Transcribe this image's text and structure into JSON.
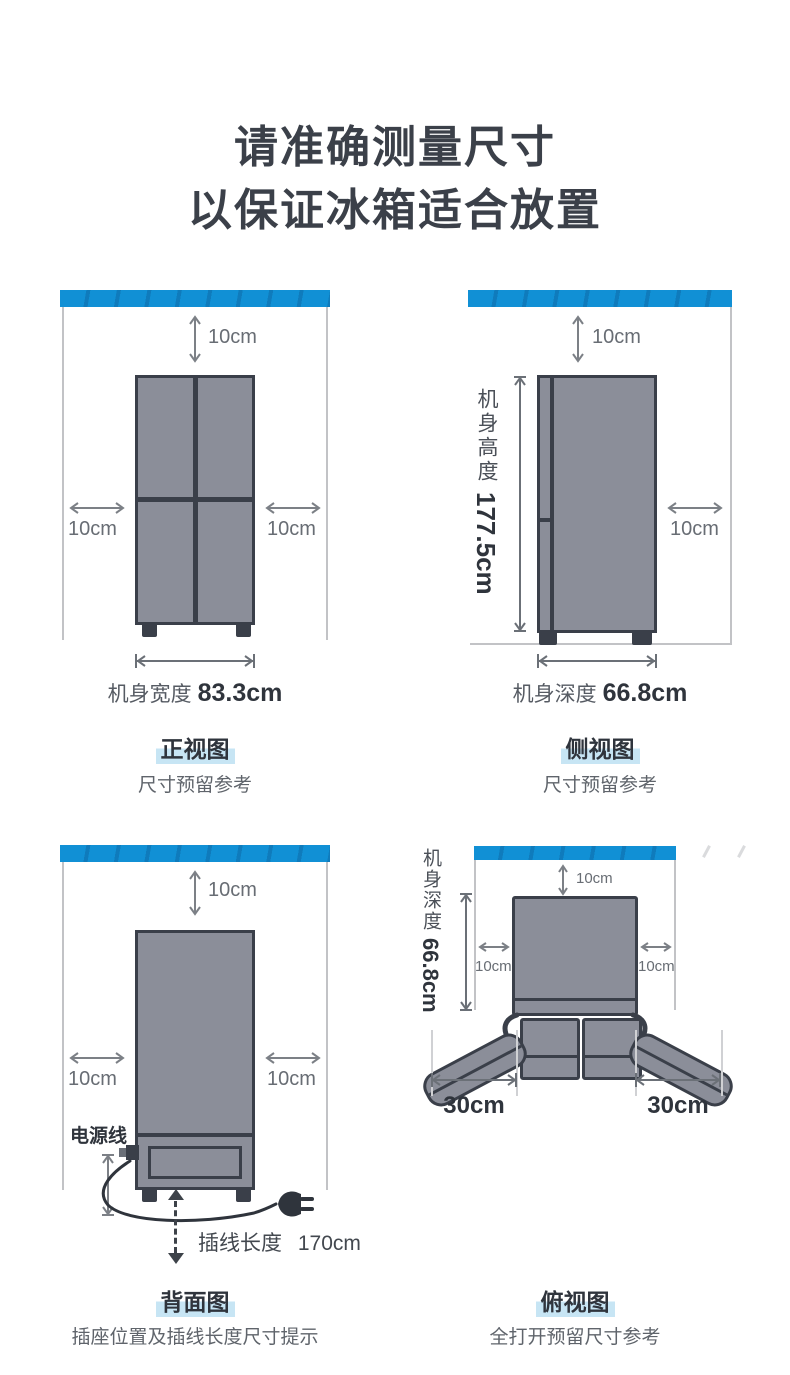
{
  "title": {
    "line1": "请准确测量尺寸",
    "line2": "以保证冰箱适合放置"
  },
  "colors": {
    "accent_blue": "#1190d5",
    "fridge_fill": "#8b8e99",
    "fridge_border": "#3a3f49",
    "dark_text": "#2f343c",
    "gray_text": "#686d74",
    "wall_gray": "#c2c3c6",
    "caption_highlight": "#c7e5f4"
  },
  "front_view": {
    "top_clearance": "10cm",
    "left_clearance": "10cm",
    "right_clearance": "10cm",
    "width_label": "机身宽度",
    "width_value": "83.3cm",
    "caption": "正视图",
    "subcaption": "尺寸预留参考"
  },
  "side_view": {
    "top_clearance": "10cm",
    "right_clearance": "10cm",
    "height_label": "机身高度",
    "height_value": "177.5cm",
    "depth_label": "机身深度",
    "depth_value": "66.8cm",
    "caption": "侧视图",
    "subcaption": "尺寸预留参考"
  },
  "back_view": {
    "top_clearance": "10cm",
    "left_clearance": "10cm",
    "right_clearance": "10cm",
    "power_cord_label": "电源线",
    "cord_length_label": "插线长度",
    "cord_length_value": "170cm",
    "caption": "背面图",
    "subcaption": "插座位置及插线长度尺寸提示"
  },
  "top_view": {
    "depth_label": "机身深度",
    "depth_value": "66.8cm",
    "top_clearance": "10cm",
    "left_clearance": "10cm",
    "right_clearance": "10cm",
    "left_door_clearance": "30cm",
    "right_door_clearance": "30cm",
    "caption": "俯视图",
    "subcaption": "全打开预留尺寸参考"
  }
}
